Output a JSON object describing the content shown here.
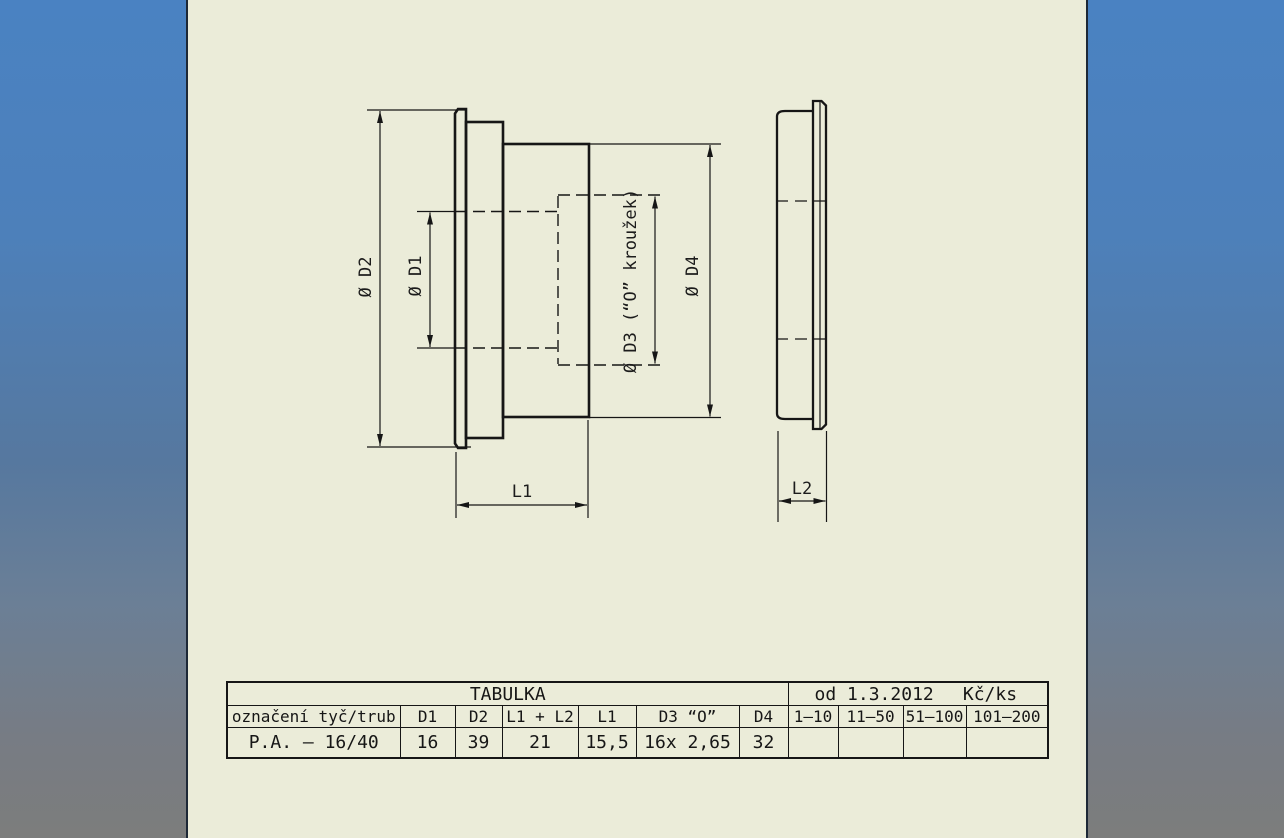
{
  "drawing": {
    "labels": {
      "d2": "Ø D2",
      "d1": "Ø D1",
      "d3": "Ø D3 (“O” kroužek)",
      "d4": "Ø D4",
      "l1": "L1",
      "l2": "L2"
    }
  },
  "table": {
    "title": "TABULKA",
    "valid_from": "od 1.3.2012",
    "unit": "Kč/ks",
    "headers": [
      "označení tyč/trub",
      "D1",
      "D2",
      "L1 + L2",
      "L1",
      "D3 “O”",
      "D4",
      "1–10",
      "11–50",
      "51–100",
      "101–200"
    ],
    "row": [
      "P.A. – 16/40",
      "16",
      "39",
      "21",
      "15,5",
      "16x 2,65",
      "32",
      "",
      "",
      "",
      ""
    ]
  },
  "colors": {
    "sheet": "#ebecd9",
    "line": "#161616",
    "background_top": "#4a82c2",
    "background_bottom": "#7c7d7c"
  }
}
